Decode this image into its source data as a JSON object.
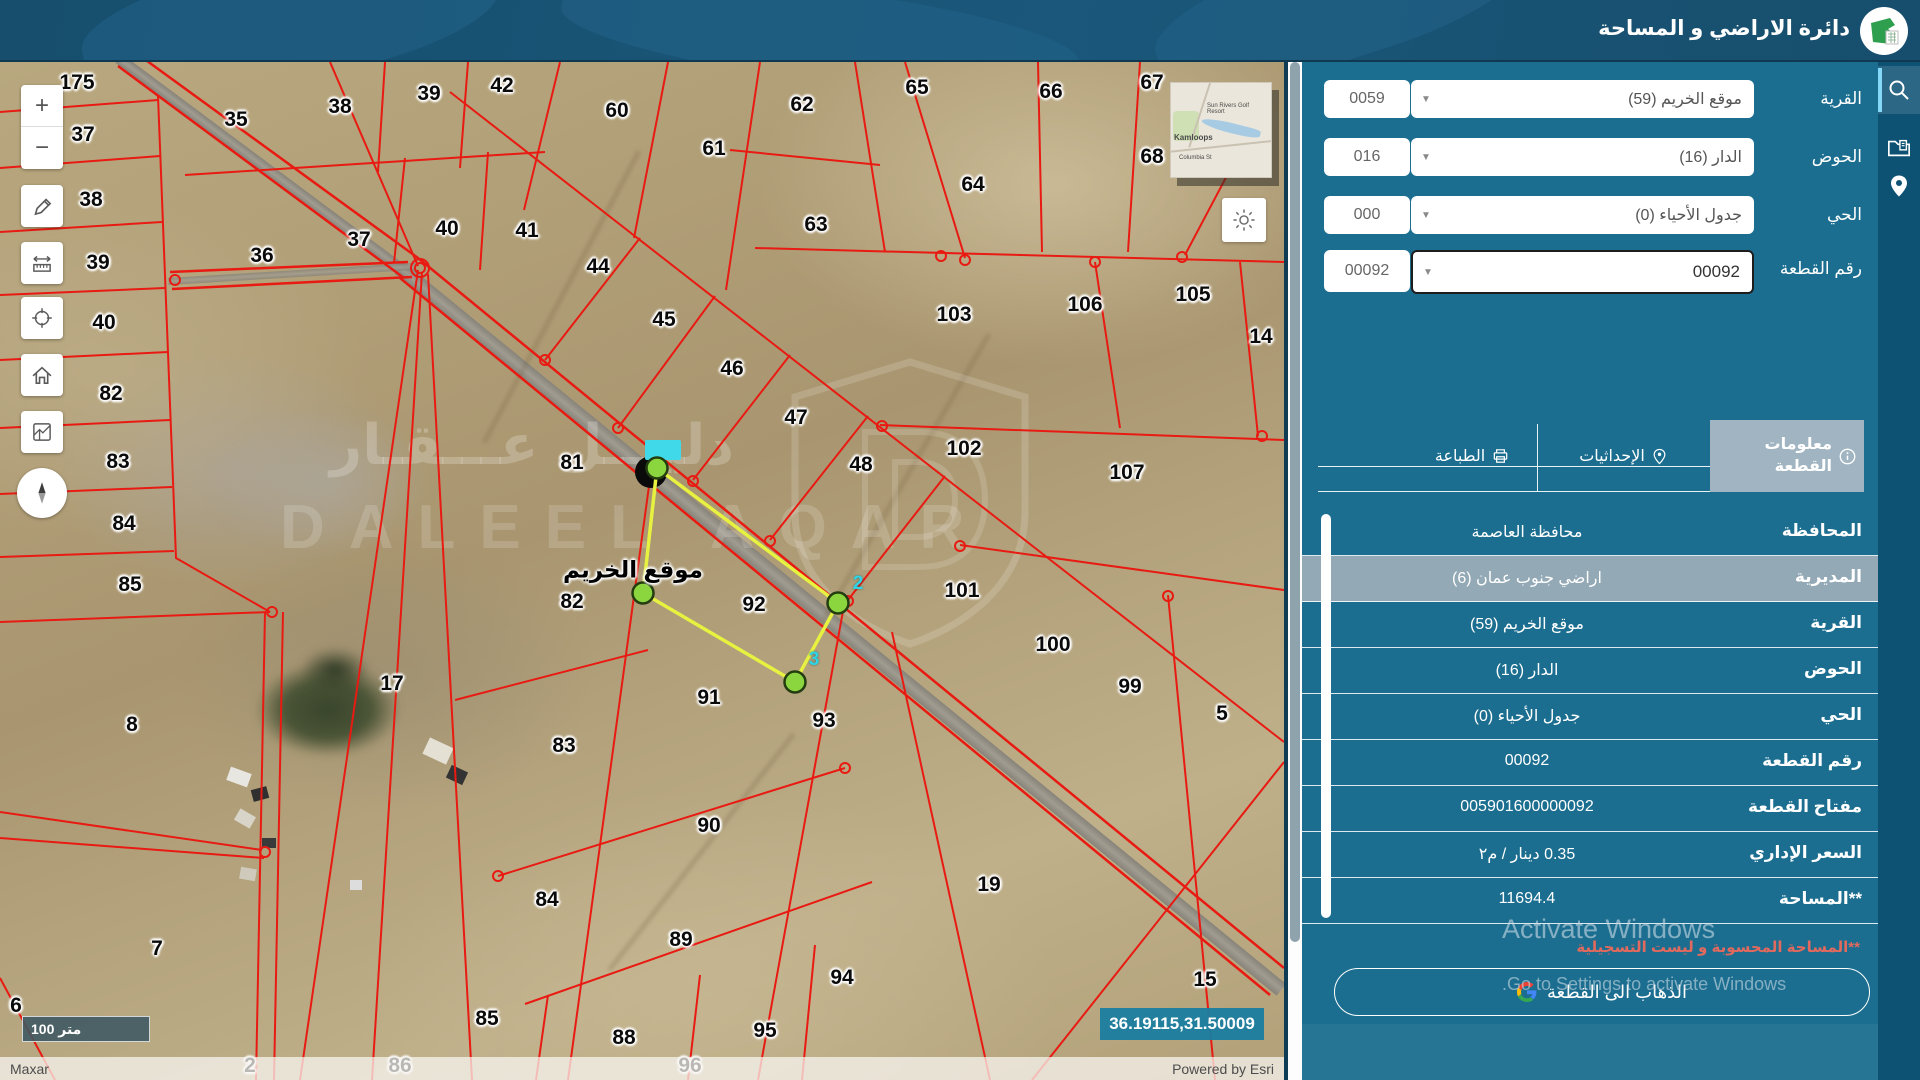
{
  "header": {
    "title": "دائرة الاراضي و المساحة"
  },
  "sidebar": {
    "form": {
      "rows": [
        {
          "label": "القرية",
          "value": "موقع الخريم (59)",
          "code": "0059"
        },
        {
          "label": "الحوض",
          "value": "الدار (16)",
          "code": "016"
        },
        {
          "label": "الحي",
          "value": "جدول الأحياء (0)",
          "code": "000"
        },
        {
          "label": "رقم القطعة",
          "value": "00092",
          "code": "00092"
        }
      ]
    },
    "tabs": [
      {
        "label": "معلومات القطعة",
        "icon": "info-icon",
        "active": true
      },
      {
        "label": "الإحداثيات",
        "icon": "pin-icon",
        "active": false
      },
      {
        "label": "الطباعة",
        "icon": "printer-icon",
        "active": false
      }
    ],
    "info_rows": [
      {
        "label": "المحافظة",
        "value": "محافظة العاصمة"
      },
      {
        "label": "المديرية",
        "value": "اراضي جنوب عمان (6)",
        "highlight": true
      },
      {
        "label": "القرية",
        "value": "موقع الخريم (59)"
      },
      {
        "label": "الحوض",
        "value": "الدار (16)"
      },
      {
        "label": "الحي",
        "value": "جدول الأحياء (0)"
      },
      {
        "label": "رقم القطعة",
        "value": "00092"
      },
      {
        "label": "مفتاح القطعة",
        "value": "005901600000092"
      },
      {
        "label": "السعر الإداري",
        "value": "0.35 دينار / م٢"
      },
      {
        "label": "**المساحة",
        "value": "11694.4"
      }
    ],
    "note": "**المساحة المحسوبة و ليست التسجيلية",
    "go_button": {
      "label": "الذهاب الى القطعة"
    }
  },
  "activate": {
    "line1": "Activate Windows",
    "line2": "Go to Settings to activate Windows."
  },
  "map": {
    "village_label": "موقع الخريم",
    "coordinates": "36.19115,31.50009",
    "scale_label": "100 متر",
    "attribution_left": "Maxar",
    "attribution_right": "Powered by Esri",
    "selected_parcel": "92",
    "watermark": {
      "arabic": "دليـــل عـــقـار",
      "latin": "DALEEL AQAR"
    },
    "inset": {
      "labels": [
        "Sun Rivers Golf Resort",
        "Kamloops",
        "Columbia St"
      ]
    },
    "cyan_labels": [
      {
        "t": "2",
        "x": 858,
        "y": 584
      },
      {
        "t": "3",
        "x": 814,
        "y": 660
      }
    ],
    "numbers": [
      {
        "t": "175",
        "x": 77,
        "y": 83
      },
      {
        "t": "37",
        "x": 83,
        "y": 135
      },
      {
        "t": "38",
        "x": 91,
        "y": 200
      },
      {
        "t": "39",
        "x": 98,
        "y": 263
      },
      {
        "t": "40",
        "x": 104,
        "y": 323
      },
      {
        "t": "82",
        "x": 111,
        "y": 394
      },
      {
        "t": "83",
        "x": 118,
        "y": 462
      },
      {
        "t": "84",
        "x": 124,
        "y": 524
      },
      {
        "t": "85",
        "x": 130,
        "y": 585
      },
      {
        "t": "35",
        "x": 236,
        "y": 120
      },
      {
        "t": "36",
        "x": 262,
        "y": 256
      },
      {
        "t": "38",
        "x": 340,
        "y": 107
      },
      {
        "t": "39",
        "x": 429,
        "y": 94
      },
      {
        "t": "42",
        "x": 502,
        "y": 86
      },
      {
        "t": "60",
        "x": 617,
        "y": 111
      },
      {
        "t": "61",
        "x": 714,
        "y": 149
      },
      {
        "t": "62",
        "x": 802,
        "y": 105
      },
      {
        "t": "65",
        "x": 917,
        "y": 88
      },
      {
        "t": "66",
        "x": 1051,
        "y": 92
      },
      {
        "t": "67",
        "x": 1152,
        "y": 83
      },
      {
        "t": "68",
        "x": 1152,
        "y": 157
      },
      {
        "t": "64",
        "x": 973,
        "y": 185
      },
      {
        "t": "63",
        "x": 816,
        "y": 225
      },
      {
        "t": "37",
        "x": 359,
        "y": 240
      },
      {
        "t": "40",
        "x": 447,
        "y": 229
      },
      {
        "t": "41",
        "x": 527,
        "y": 231
      },
      {
        "t": "44",
        "x": 598,
        "y": 267
      },
      {
        "t": "45",
        "x": 664,
        "y": 320
      },
      {
        "t": "46",
        "x": 732,
        "y": 369
      },
      {
        "t": "47",
        "x": 796,
        "y": 418
      },
      {
        "t": "48",
        "x": 861,
        "y": 465
      },
      {
        "t": "103",
        "x": 954,
        "y": 315
      },
      {
        "t": "106",
        "x": 1085,
        "y": 305
      },
      {
        "t": "105",
        "x": 1193,
        "y": 295
      },
      {
        "t": "14",
        "x": 1261,
        "y": 337
      },
      {
        "t": "102",
        "x": 964,
        "y": 449
      },
      {
        "t": "107",
        "x": 1127,
        "y": 473
      },
      {
        "t": "81",
        "x": 572,
        "y": 463
      },
      {
        "t": "82",
        "x": 572,
        "y": 602
      },
      {
        "t": "92",
        "x": 754,
        "y": 605
      },
      {
        "t": "101",
        "x": 962,
        "y": 591
      },
      {
        "t": "100",
        "x": 1053,
        "y": 645
      },
      {
        "t": "99",
        "x": 1130,
        "y": 687
      },
      {
        "t": "5",
        "x": 1222,
        "y": 714
      },
      {
        "t": "17",
        "x": 392,
        "y": 684
      },
      {
        "t": "91",
        "x": 709,
        "y": 698
      },
      {
        "t": "93",
        "x": 824,
        "y": 721
      },
      {
        "t": "83",
        "x": 564,
        "y": 746
      },
      {
        "t": "8",
        "x": 132,
        "y": 725
      },
      {
        "t": "90",
        "x": 709,
        "y": 826
      },
      {
        "t": "19",
        "x": 989,
        "y": 885
      },
      {
        "t": "84",
        "x": 547,
        "y": 900
      },
      {
        "t": "89",
        "x": 681,
        "y": 940
      },
      {
        "t": "94",
        "x": 842,
        "y": 978
      },
      {
        "t": "7",
        "x": 157,
        "y": 949
      },
      {
        "t": "15",
        "x": 1205,
        "y": 980
      },
      {
        "t": "6",
        "x": 16,
        "y": 1006
      },
      {
        "t": "85",
        "x": 487,
        "y": 1019
      },
      {
        "t": "88",
        "x": 624,
        "y": 1038
      },
      {
        "t": "95",
        "x": 765,
        "y": 1031
      },
      {
        "t": "2",
        "x": 250,
        "y": 1066
      },
      {
        "t": "86",
        "x": 400,
        "y": 1066
      },
      {
        "t": "96",
        "x": 690,
        "y": 1066
      }
    ]
  }
}
